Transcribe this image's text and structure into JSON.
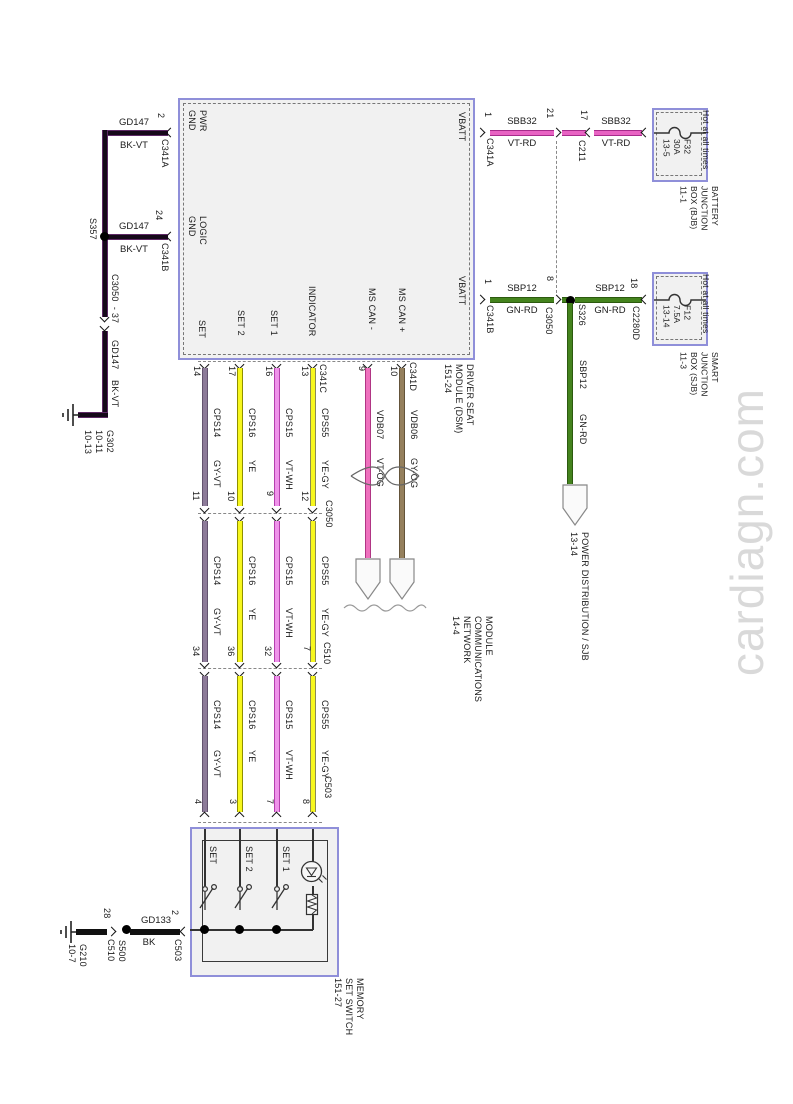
{
  "watermark": "cardiagn.com",
  "colors": {
    "box_border": "#8f8fd9",
    "bk_vt": {
      "core": "#16091a",
      "edge": "#5e2a66"
    },
    "vt_rd": {
      "core": "#e863c3",
      "edge": "#a72b8b"
    },
    "gn_rd": {
      "core": "#44831d",
      "edge": "#2c5a0f"
    },
    "gy_vt": {
      "core": "#8d7b99",
      "edge": "#63536f"
    },
    "ye": {
      "core": "#f7f71d",
      "edge": "#8f8f00"
    },
    "vt_wh": {
      "core": "#ef93ea",
      "edge": "#b53fae"
    },
    "ye_gy": {
      "core": "#f7f71d",
      "edge": "#8a8a52"
    },
    "vt_og": {
      "core": "#ee70bd",
      "edge": "#b03584"
    },
    "gy_og": {
      "core": "#95805d",
      "edge": "#64543a"
    },
    "bk": {
      "core": "#111111",
      "edge": "#111111"
    }
  },
  "left": {
    "pwr_pin": "2",
    "pwr_conn": "C341A",
    "logic_pin": "24",
    "logic_conn": "C341B",
    "wire": "GD147",
    "color": "BK-VT",
    "splice": "S357",
    "inline": "C3050  - 37",
    "wire2": "GD147",
    "color2": "BK-VT",
    "ground": "G302\n10-11\n10-13"
  },
  "module": {
    "pwr_gnd": "PWR\nGND",
    "logic_gnd": "LOGIC\nGND",
    "vbatt": "VBATT",
    "set": "SET",
    "set2": "SET 2",
    "set1": "SET 1",
    "indicator": "INDICATOR",
    "can_minus": "MS CAN -",
    "can_plus": "MS CAN +",
    "name": "DRIVER SEAT\nMODULE (DSM)\n151-24",
    "conn_c": "C341C",
    "conn_d": "C341D"
  },
  "vbatt1": {
    "pin": "1",
    "conn": "C341A",
    "wire": "SBB32",
    "color": "VT-RD",
    "pin_a": "21",
    "pin_b": "17",
    "conn_inline": "C211"
  },
  "bjb": {
    "hot": "Hot at all times",
    "fuse": "F32\n30A\n13-5",
    "name": "BATTERY\nJUNCTION\nBOX (BJB)\n11-1"
  },
  "vbatt2": {
    "pin": "1",
    "conn": "C341B",
    "wire": "SBP12",
    "color": "GN-RD",
    "pin_a": "8",
    "conn_inline": "C3050",
    "splice": "S326",
    "pin_b": "18",
    "conn_b": "C2280D"
  },
  "sjb": {
    "hot": "Hot at all times",
    "fuse": "F12\n7.5A\n13-14",
    "name": "SMART\nJUNCTION\nBOX (SJB)\n11-3"
  },
  "power": {
    "wire": "SBP12",
    "color": "GN-RD",
    "dest": "POWER DISTRIBUTION / SJB\n13-14"
  },
  "rows": {
    "c3050": "C3050",
    "c510": "C510",
    "c503": "C503"
  },
  "wires": [
    {
      "module_pin": "14",
      "name": "CPS14",
      "color": "GY-VT",
      "p1": "11",
      "p2": "34",
      "p3": "4"
    },
    {
      "module_pin": "17",
      "name": "CPS16",
      "color": "YE",
      "p1": "10",
      "p2": "36",
      "p3": "3"
    },
    {
      "module_pin": "16",
      "name": "CPS15",
      "color": "VT-WH",
      "p1": "9",
      "p2": "32",
      "p3": "7"
    },
    {
      "module_pin": "13",
      "name": "CPS55",
      "color": "YE-GY",
      "p1": "12",
      "p2": "7",
      "p3": "8"
    }
  ],
  "can": {
    "minus_pin": "9",
    "minus_name": "VDB07",
    "minus_color": "VT-OG",
    "plus_pin": "10",
    "plus_name": "VDB06",
    "plus_color": "GY-OG",
    "dest": "MODULE\nCOMMUNICATIONS\nNETWORK\n14-4"
  },
  "switch": {
    "name": "MEMORY\nSET SWITCH\n151-27",
    "set": "SET",
    "set2": "SET 2",
    "set1": "SET 1",
    "ground": "G210\n10-7",
    "pin28": "28",
    "c510": "C510",
    "splice": "S500",
    "wire": "GD133",
    "color": "BK",
    "pin2": "2",
    "c503": "C503"
  }
}
